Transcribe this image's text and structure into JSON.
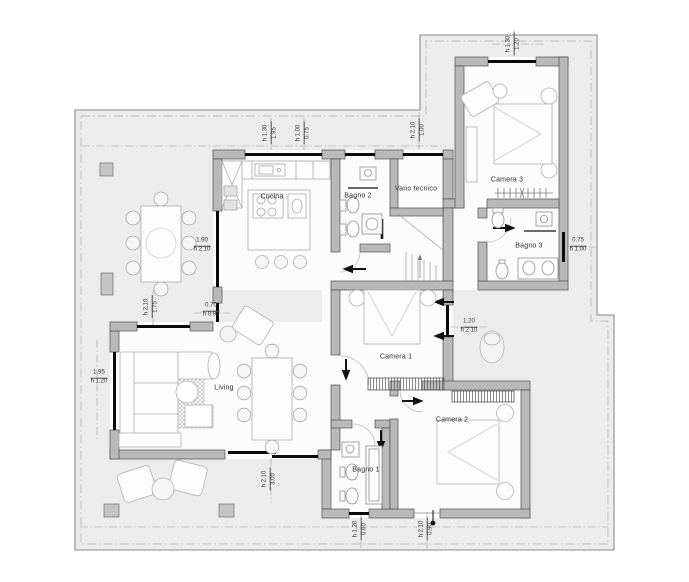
{
  "drawing": {
    "kind": "residential floor plan"
  },
  "rooms": [
    {
      "id": "cucina",
      "label": "Cucina"
    },
    {
      "id": "bagno-2",
      "label": "Bagno 2"
    },
    {
      "id": "vano-tecnico",
      "label": "Vano tecnico"
    },
    {
      "id": "camera-3",
      "label": "Camera 3"
    },
    {
      "id": "bagno-3",
      "label": "Bagno 3"
    },
    {
      "id": "camera-1",
      "label": "Camera 1"
    },
    {
      "id": "camera-2",
      "label": "Camera 2"
    },
    {
      "id": "bagno-1",
      "label": "Bagno 1"
    },
    {
      "id": "living",
      "label": "Living"
    }
  ],
  "dimensions": [
    {
      "id": "kitchen-north-window",
      "width": "1.95",
      "height": "h 1.30"
    },
    {
      "id": "bath2-north-window",
      "width": "0.75",
      "height": "h 1.00"
    },
    {
      "id": "north-entry-door",
      "width": "1.00",
      "height": "h 2.10"
    },
    {
      "id": "camera3-north-window",
      "width": "1.20",
      "height": "h 1.30"
    },
    {
      "id": "bagno3-east-window",
      "width": "0.75",
      "height": "h 1.00"
    },
    {
      "id": "kitchen-west-window",
      "width": "1.90",
      "height": "h 2.10"
    },
    {
      "id": "kitchen-pass-window",
      "width": "0.70",
      "height": "h 0.90"
    },
    {
      "id": "living-north-opening",
      "width": "1.75",
      "height": "h 2.10"
    },
    {
      "id": "living-west-window",
      "width": "1.95",
      "height": "h 1.20"
    },
    {
      "id": "camera1-east-door",
      "width": "1.20",
      "height": "h 2.10"
    },
    {
      "id": "living-south-slider",
      "width": "3.00",
      "height": "h 2.10"
    },
    {
      "id": "bagno1-south-window",
      "width": "0.60",
      "height": "h 1.20"
    },
    {
      "id": "camera2-south-door",
      "width": "0.90",
      "height": "h 2.10"
    }
  ],
  "colors": {
    "terrace": "#ececec",
    "floor": "#fcfcfc",
    "wall": "#b9b9b9",
    "wall_edge": "#4f4f4f",
    "glazing": "#0a0a0a",
    "furniture_stroke": "#a9a9a9",
    "label_text": "#2d2d2d"
  }
}
